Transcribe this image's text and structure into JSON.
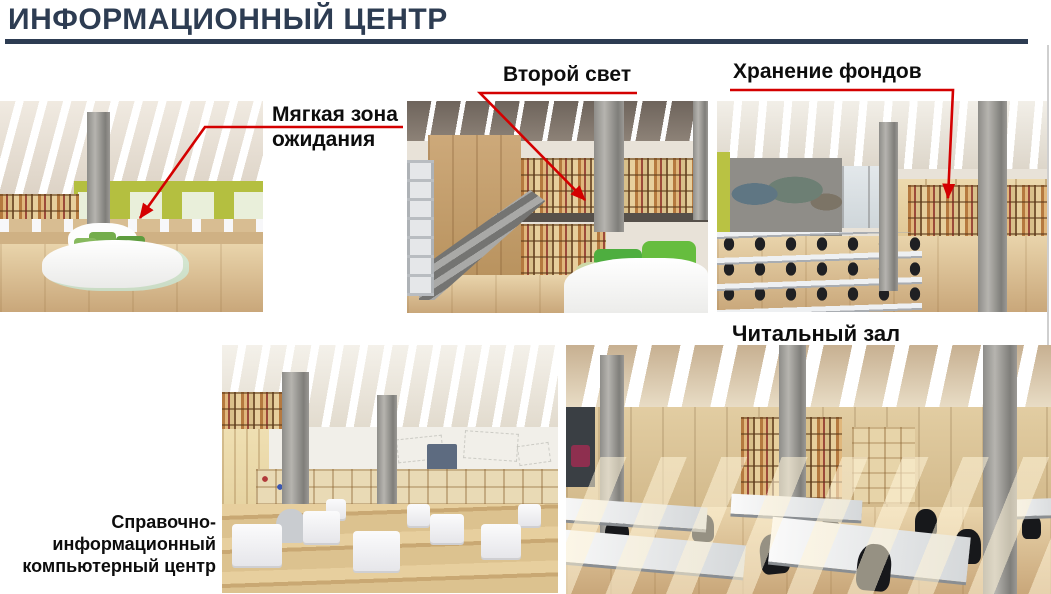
{
  "slide": {
    "title": "ИНФОРМАЦИОННЫЙ ЦЕНТР"
  },
  "theme": {
    "title_color": "#2d3c52",
    "title_rule_color": "#2d3c52",
    "arrow_color": "#d40000",
    "label_color": "#0d0d0d",
    "slide_edge_color": "#cfcfcf"
  },
  "labels": {
    "soft_zone": "Мягкая зона\nожидания",
    "second_light": "Второй свет",
    "storage": "Хранение фондов",
    "reading_hall": "Читальный зал",
    "computer_center": "Справочно-\nинформационный\nкомпьютерный центр"
  }
}
